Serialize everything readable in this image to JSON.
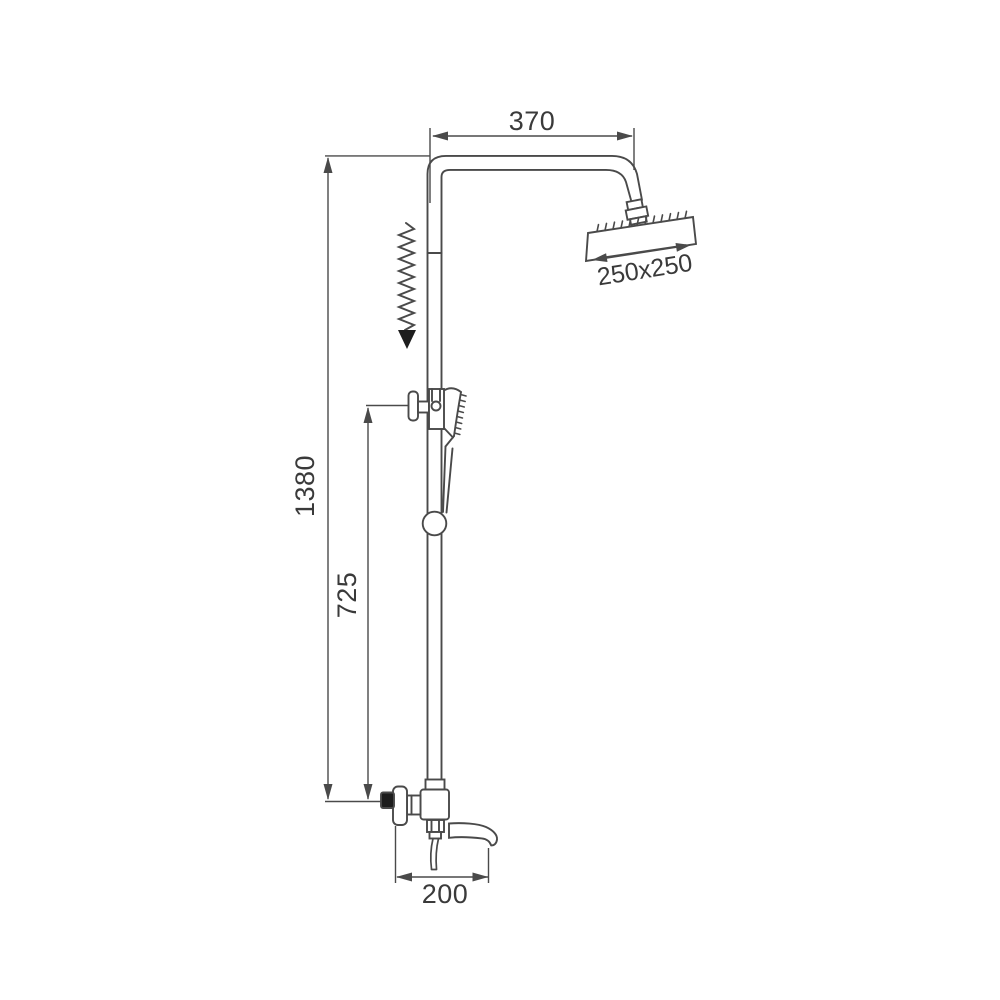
{
  "figure": {
    "kind": "technical-dimension-drawing",
    "subject": "shower column with rain head, hand shower and tub spout",
    "background": "#ffffff",
    "line_color": "#4a4a4a",
    "text_color": "#3a3a3a"
  },
  "dimensions": {
    "arm_width": "370",
    "head_size": "250x250",
    "total_height": "1380",
    "bracket_height": "725",
    "spout_length": "200"
  },
  "icons": {
    "slide_indicator": "zigzag-down-arrow"
  }
}
